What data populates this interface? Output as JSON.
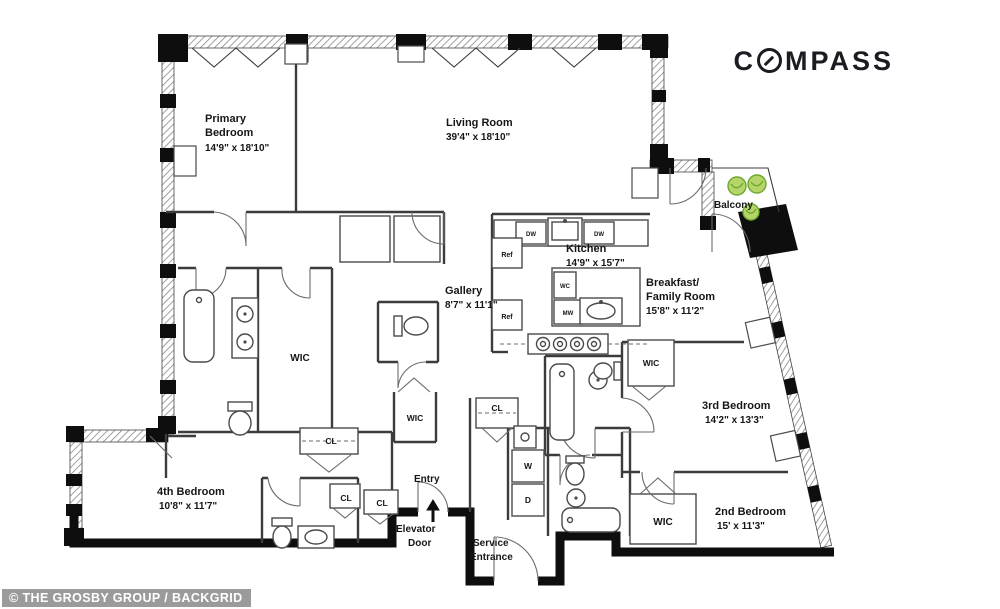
{
  "branding": {
    "logo_prefix": "C",
    "logo_suffix": "MPASS"
  },
  "watermark": {
    "text": "© THE GROSBY GROUP / BACKGRID"
  },
  "rooms": {
    "primary_bedroom": {
      "line1": "Primary",
      "line2": "Bedroom",
      "dims": "14'9\" x 18'10\""
    },
    "living_room": {
      "name": "Living Room",
      "dims": "39'4\" x 18'10\""
    },
    "kitchen": {
      "name": "Kitchen",
      "dims": "14'9\" x 15'7\""
    },
    "breakfast_family": {
      "line1": "Breakfast/",
      "line2": "Family Room",
      "dims": "15'8\" x 11'2\""
    },
    "gallery": {
      "name": "Gallery",
      "dims": "8'7\" x 11'1\""
    },
    "third_bedroom": {
      "name": "3rd Bedroom",
      "dims": "14'2\" x 13'3\""
    },
    "second_bedroom": {
      "name": "2nd Bedroom",
      "dims": "15' x 11'3\""
    },
    "fourth_bedroom": {
      "name": "4th Bedroom",
      "dims": "10'8\" x 11'7\""
    },
    "balcony": {
      "name": "Balcony"
    },
    "entry": {
      "name": "Entry"
    },
    "elevator_door": {
      "line1": "Elevator",
      "line2": "Door"
    },
    "service_entrance": {
      "line1": "Service",
      "line2": "Entrance"
    }
  },
  "fixtures": {
    "walk_in_closet": "WIC",
    "closet": "CL",
    "refrigerator": "Ref",
    "dishwasher": "DW",
    "microwave": "MW",
    "wine_cooler": "WC",
    "washer": "W",
    "dryer": "D"
  },
  "colors": {
    "wall": "#0e0e0e",
    "line": "#3c3c3c",
    "plant_fill": "#b5d56a",
    "plant_stroke": "#6fa82e",
    "watermark_bg": "#9b9b9b",
    "watermark_text": "#ffffff",
    "logo": "#1b1b22"
  }
}
